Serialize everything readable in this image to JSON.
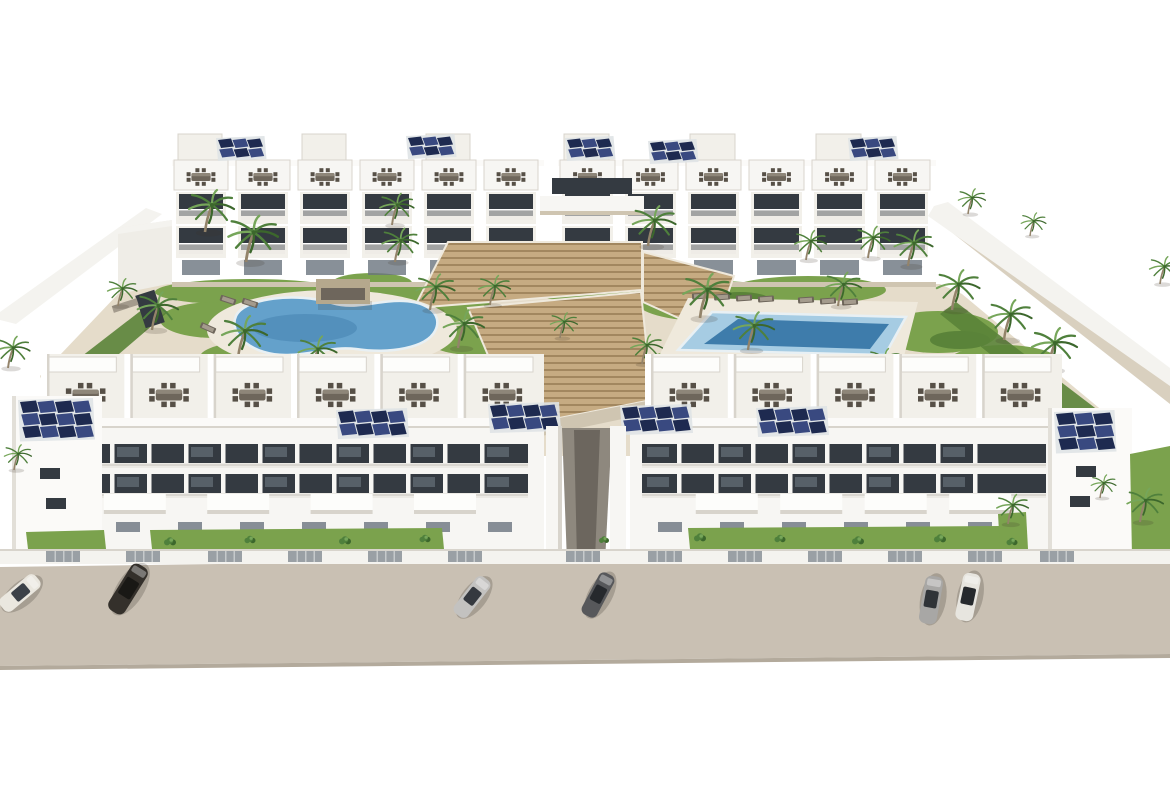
{
  "meta": {
    "title": "Aerial 3D architectural render of a white apartment complex",
    "scene_summary": "Two rows of white three-storey apartment blocks around a landscaped courtyard with a kidney-shaped pool on the left, a rectangular pool on the right, central timber stepped terraces, palm trees, rooftop terraces with dining sets, blue solar panel arrays on the roofs, a perimeter wall, front lawns with a white fence, and a beige street with six parked cars"
  },
  "colors": {
    "street": "#c9c0b3",
    "streetEdge": "#b3aa9c",
    "wall": "#f4f3ef",
    "wallShade": "#e2dfd8",
    "bldg": "#f7f6f3",
    "bldgShade": "#efede7",
    "bldgPanel": "#f2f0ea",
    "parapet": "#fbfaf8",
    "line": "#d8d4cc",
    "winDark": "#343a41",
    "winMid": "#6a747e",
    "railing": "#eceae5",
    "railLine": "#c7c4bd",
    "solarA": "#1e2a50",
    "solarB": "#394980",
    "solarFrame": "#dfe3e6",
    "poolBlue": "#64a1cb",
    "poolDeep": "#3e7cab",
    "poolPale": "#a6cce3",
    "poolRim": "#e8f0f4",
    "deck": "#efe9dc",
    "sand": "#e5dcca",
    "sandOut": "#d9d0bf",
    "sandShade": "#cfc5b1",
    "wood": "#c6ab82",
    "woodDark": "#a2875f",
    "grass": "#7ba24d",
    "grassDark": "#5a8339",
    "palm": "#4f803c",
    "palmLight": "#76a65a",
    "palmDark": "#3c672c",
    "trunk": "#93836a",
    "furn": "#6e665b",
    "furnDark": "#575047",
    "furnLight": "#a49b8d",
    "canopy": "#fdfdfb",
    "pergola": "#b5a88d",
    "pergolaDark": "#6e665c",
    "slat": "#9aa0a5",
    "slatLine": "#c6cacc",
    "passage": "#8e887e",
    "passageDark": "#6c665e",
    "shadow": "rgba(60,50,40,0.18)"
  },
  "back_blocks": [
    {
      "x": 172,
      "w": 372,
      "modules": 6
    },
    {
      "x": 558,
      "w": 378,
      "modules": 6
    }
  ],
  "back_solar": [
    {
      "x": 218,
      "y": 140,
      "cols": 3,
      "rows": 2,
      "pw": 13,
      "ph": 8
    },
    {
      "x": 408,
      "y": 138,
      "cols": 3,
      "rows": 2,
      "pw": 13,
      "ph": 8
    },
    {
      "x": 567,
      "y": 140,
      "cols": 3,
      "rows": 2,
      "pw": 13,
      "ph": 8
    },
    {
      "x": 650,
      "y": 143,
      "cols": 3,
      "rows": 2,
      "pw": 13,
      "ph": 8
    },
    {
      "x": 850,
      "y": 140,
      "cols": 3,
      "rows": 2,
      "pw": 13,
      "ph": 8
    }
  ],
  "front_blocks": [
    {
      "x": 14,
      "w": 530,
      "bays": 6,
      "solar": [
        {
          "x": 338,
          "y": 412,
          "cols": 4,
          "rows": 2,
          "pw": 15,
          "ph": 11
        },
        {
          "x": 490,
          "y": 406,
          "cols": 4,
          "rows": 2,
          "pw": 15,
          "ph": 11
        }
      ],
      "tower": {
        "x": 12,
        "y": 396,
        "w": 90,
        "h": 162,
        "solar": {
          "x": 20,
          "y": 402,
          "cols": 4,
          "rows": 3,
          "pw": 16,
          "ph": 11
        },
        "windows": [
          [
            40,
            468
          ],
          [
            46,
            498
          ]
        ]
      }
    },
    {
      "x": 618,
      "w": 444,
      "bays": 5,
      "solar": [
        {
          "x": 622,
          "y": 408,
          "cols": 4,
          "rows": 2,
          "pw": 15,
          "ph": 11
        },
        {
          "x": 758,
          "y": 410,
          "cols": 4,
          "rows": 2,
          "pw": 15,
          "ph": 11
        }
      ],
      "tower": {
        "x": 1048,
        "y": 408,
        "w": 84,
        "h": 148,
        "solar": {
          "x": 1056,
          "y": 414,
          "cols": 3,
          "rows": 3,
          "pw": 17,
          "ph": 11
        },
        "windows": [
          [
            1076,
            466
          ],
          [
            1070,
            496
          ]
        ]
      }
    }
  ],
  "palms": {
    "courtyard": [
      [
        205,
        232,
        1.0
      ],
      [
        246,
        262,
        1.1
      ],
      [
        152,
        330,
        0.9
      ],
      [
        238,
        358,
        1.0
      ],
      [
        312,
        372,
        0.85
      ],
      [
        392,
        225,
        0.75
      ],
      [
        395,
        262,
        0.8
      ],
      [
        430,
        310,
        0.85
      ],
      [
        458,
        348,
        0.9
      ],
      [
        490,
        305,
        0.7
      ],
      [
        560,
        338,
        0.6
      ],
      [
        648,
        246,
        0.95
      ],
      [
        700,
        318,
        1.05
      ],
      [
        748,
        350,
        0.9
      ],
      [
        806,
        260,
        0.7
      ],
      [
        838,
        306,
        0.8
      ],
      [
        868,
        258,
        0.75
      ],
      [
        908,
        266,
        0.85
      ],
      [
        952,
        310,
        0.95
      ],
      [
        1004,
        340,
        0.95
      ],
      [
        1048,
        370,
        1.0
      ],
      [
        988,
        398,
        0.8
      ],
      [
        880,
        378,
        0.7
      ],
      [
        642,
        364,
        0.7
      ],
      [
        968,
        214,
        0.6
      ],
      [
        1030,
        236,
        0.55
      ],
      [
        1160,
        284,
        0.65
      ],
      [
        118,
        306,
        0.65
      ],
      [
        8,
        368,
        0.75
      ]
    ],
    "front": [
      [
        1008,
        524,
        0.7
      ],
      [
        1140,
        522,
        0.8
      ],
      [
        1100,
        498,
        0.55
      ],
      [
        14,
        470,
        0.6
      ]
    ]
  },
  "bushes": [
    [
      170,
      543,
      0.6
    ],
    [
      250,
      541,
      0.55
    ],
    [
      345,
      542,
      0.6
    ],
    [
      425,
      540,
      0.55
    ],
    [
      700,
      539,
      0.6
    ],
    [
      780,
      540,
      0.55
    ],
    [
      858,
      542,
      0.6
    ],
    [
      940,
      540,
      0.6
    ],
    [
      1012,
      543,
      0.55
    ],
    [
      604,
      541,
      0.5
    ]
  ],
  "loungers": [
    [
      700,
      296,
      -4
    ],
    [
      722,
      297,
      -4
    ],
    [
      744,
      298,
      -4
    ],
    [
      766,
      299,
      -4
    ],
    [
      806,
      300,
      -4
    ],
    [
      828,
      301,
      -4
    ],
    [
      850,
      302,
      -4
    ],
    [
      250,
      303,
      18
    ],
    [
      228,
      300,
      18
    ],
    [
      208,
      328,
      24
    ]
  ],
  "fence": {
    "y": 549,
    "h": 15,
    "slat_w": 34,
    "slat_h": 11,
    "slats": [
      46,
      126,
      208,
      288,
      368,
      448,
      566,
      648,
      728,
      808,
      888,
      968,
      1040
    ]
  },
  "cars": [
    {
      "x": 20,
      "y": 593,
      "rot": -40,
      "len": 46,
      "wid": 17,
      "body": "#eae7df",
      "glass": "#3c4148"
    },
    {
      "x": 128,
      "y": 589,
      "rot": -58,
      "len": 54,
      "wid": 19,
      "body": "#34302b",
      "glass": "#191815"
    },
    {
      "x": 472,
      "y": 597,
      "rot": -52,
      "len": 46,
      "wid": 17,
      "body": "#c3c2c0",
      "glass": "#35393f"
    },
    {
      "x": 598,
      "y": 595,
      "rot": -62,
      "len": 47,
      "wid": 17,
      "body": "#57585b",
      "glass": "#26292d"
    },
    {
      "x": 931,
      "y": 600,
      "rot": -80,
      "len": 48,
      "wid": 18,
      "body": "#a8a7a5",
      "glass": "#303438"
    },
    {
      "x": 968,
      "y": 597,
      "rot": -78,
      "len": 48,
      "wid": 18,
      "body": "#e7e5df",
      "glass": "#26292d"
    }
  ]
}
